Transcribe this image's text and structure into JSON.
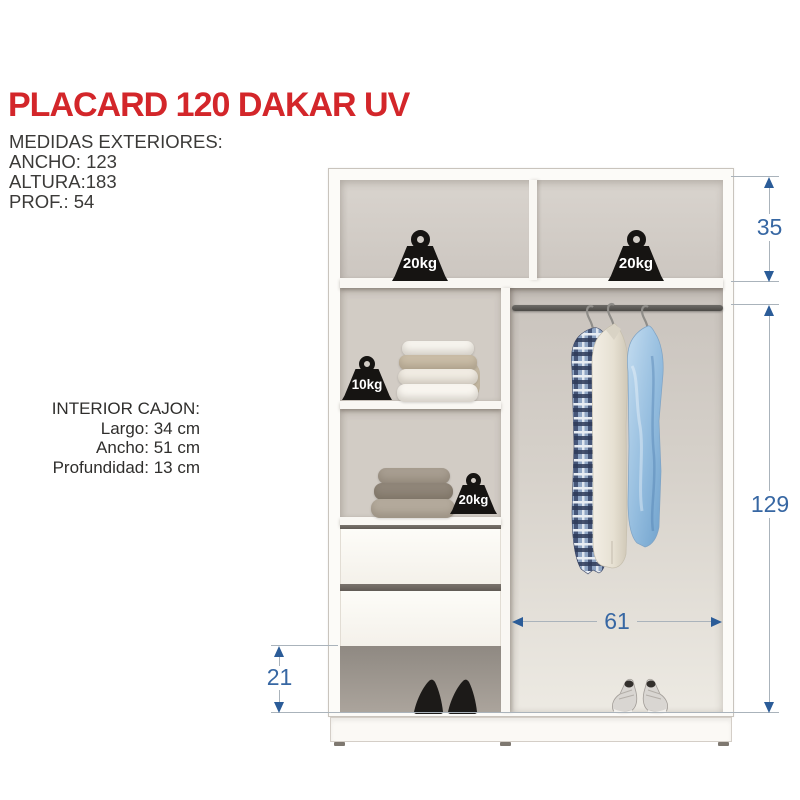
{
  "title": "PLACARD 120 DAKAR UV",
  "exterior_measures": {
    "heading": "MEDIDAS EXTERIORES:",
    "ancho": "ANCHO: 123",
    "altura": "ALTURA:183",
    "prof": "PROF.: 54"
  },
  "interior_cajon": {
    "heading": "INTERIOR CAJON:",
    "largo": "Largo: 34 cm",
    "ancho": "Ancho: 51 cm",
    "profundidad": "Profundidad: 13 cm"
  },
  "wardrobe": {
    "weights": {
      "top_left": "20kg",
      "top_right": "20kg",
      "middle_shelf": "10kg",
      "lower_shelf": "20kg"
    },
    "dimensions": {
      "top_compartment_height": "35",
      "main_compartment_height": "129",
      "hanging_area_width": "61",
      "bottom_compartment_height": "21"
    }
  },
  "colors": {
    "title_red": "#d3262a",
    "dimension_blue": "#3767a3",
    "arrow_blue": "#2b5c98",
    "weight_black": "#161412",
    "body_text": "#3b3a38",
    "interior_gray": "#d2ccc5",
    "frame_white": "#fcfbf8"
  }
}
